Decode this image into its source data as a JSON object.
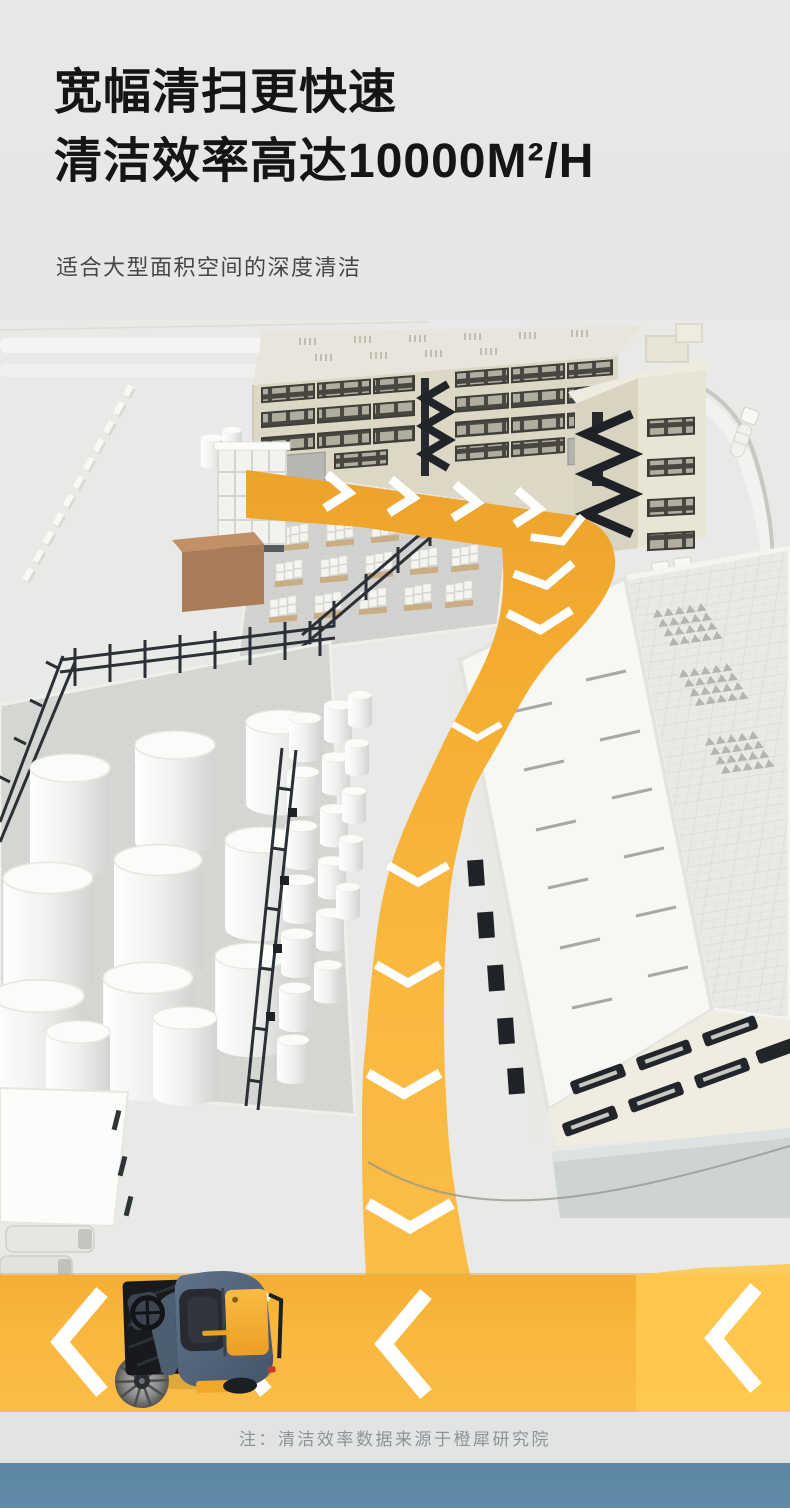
{
  "page": {
    "background_color": "#e6e6e8",
    "accent_yellow": "#f8b63e",
    "route_marking_color": "#ffffff",
    "note_strip_color": "#e2e3e3",
    "bottom_band_color": "#6189a8"
  },
  "header": {
    "title_line1": "宽幅清扫更快速",
    "title_line2": "清洁效率高达10000M²/H",
    "subtitle": "适合大型面积空间的深度清洁"
  },
  "footer": {
    "note": "注：清洁效率数据来源于橙犀研究院"
  }
}
